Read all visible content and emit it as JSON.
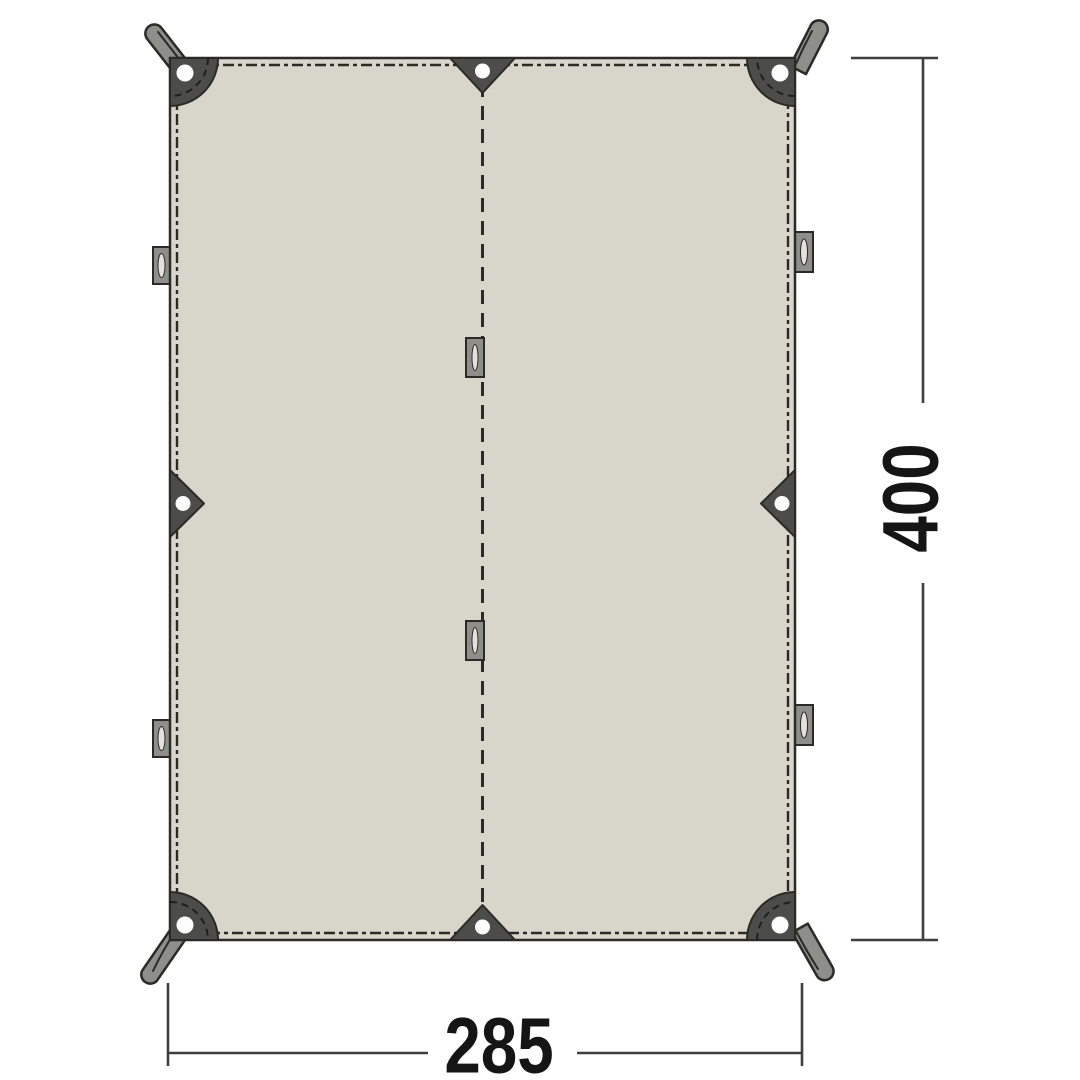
{
  "dimensions": {
    "height_label": "400",
    "width_label": "285"
  },
  "colors": {
    "background": "#ffffff",
    "fabric": "#d8d5cb",
    "patch": "#4c4c4a",
    "strap": "#8e8e8b",
    "outline": "#2b2a27",
    "grommet": "#fdfdfd",
    "slot": "#e3e1d9",
    "dimension-line": "#3f3f3f",
    "label-text": "#151515"
  }
}
